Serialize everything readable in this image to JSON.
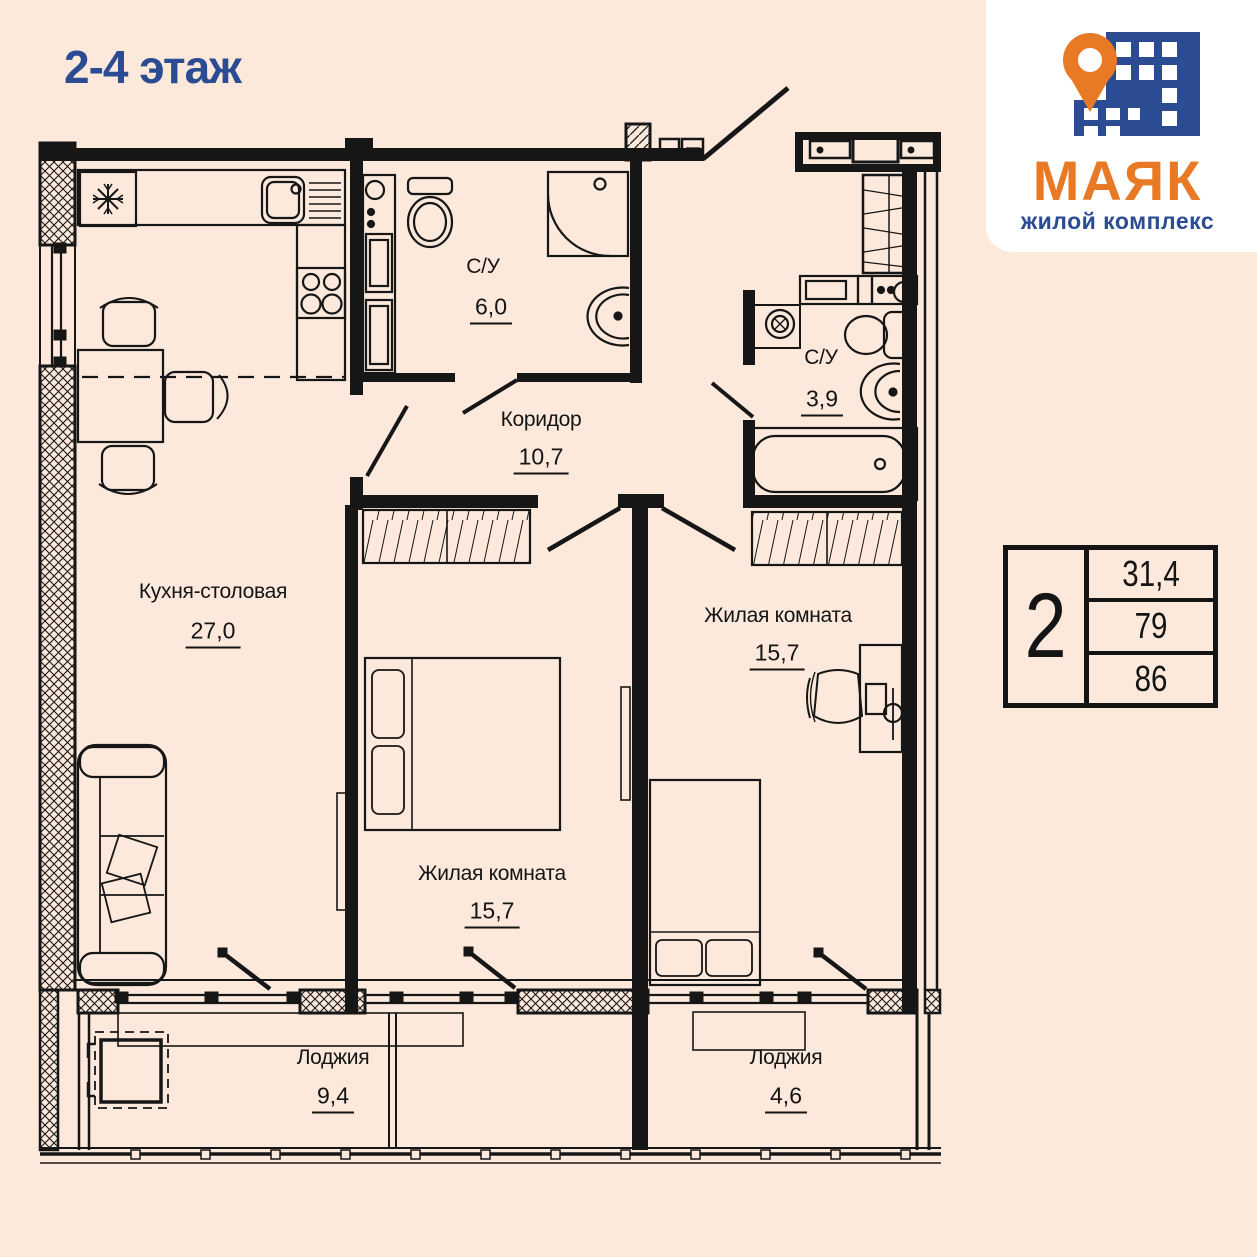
{
  "page": {
    "background_color": "#fce9dc",
    "line_color": "#161616"
  },
  "header": {
    "title": "2-4 этаж",
    "title_color": "#2b4b93"
  },
  "logo": {
    "name": "МАЯК",
    "subtitle": "жилой комплекс",
    "orange": "#e87a26",
    "blue": "#2b4b93",
    "icons": [
      "map-pin-icon",
      "building-icon"
    ]
  },
  "info_table": {
    "rooms_count": "2",
    "values": [
      "31,4",
      "79",
      "86"
    ]
  },
  "rooms": [
    {
      "id": "kitchen",
      "name": "Кухня-столовая",
      "area": "27,0"
    },
    {
      "id": "bathroom-1",
      "name": "С/У",
      "area": "6,0"
    },
    {
      "id": "corridor",
      "name": "Коридор",
      "area": "10,7"
    },
    {
      "id": "bathroom-2",
      "name": "С/У",
      "area": "3,9"
    },
    {
      "id": "bedroom-mid",
      "name": "Жилая комната",
      "area": "15,7"
    },
    {
      "id": "bedroom-right",
      "name": "Жилая комната",
      "area": "15,7"
    },
    {
      "id": "loggia-left",
      "name": "Лоджия",
      "area": "9,4"
    },
    {
      "id": "loggia-right",
      "name": "Лоджия",
      "area": "4,6"
    }
  ]
}
